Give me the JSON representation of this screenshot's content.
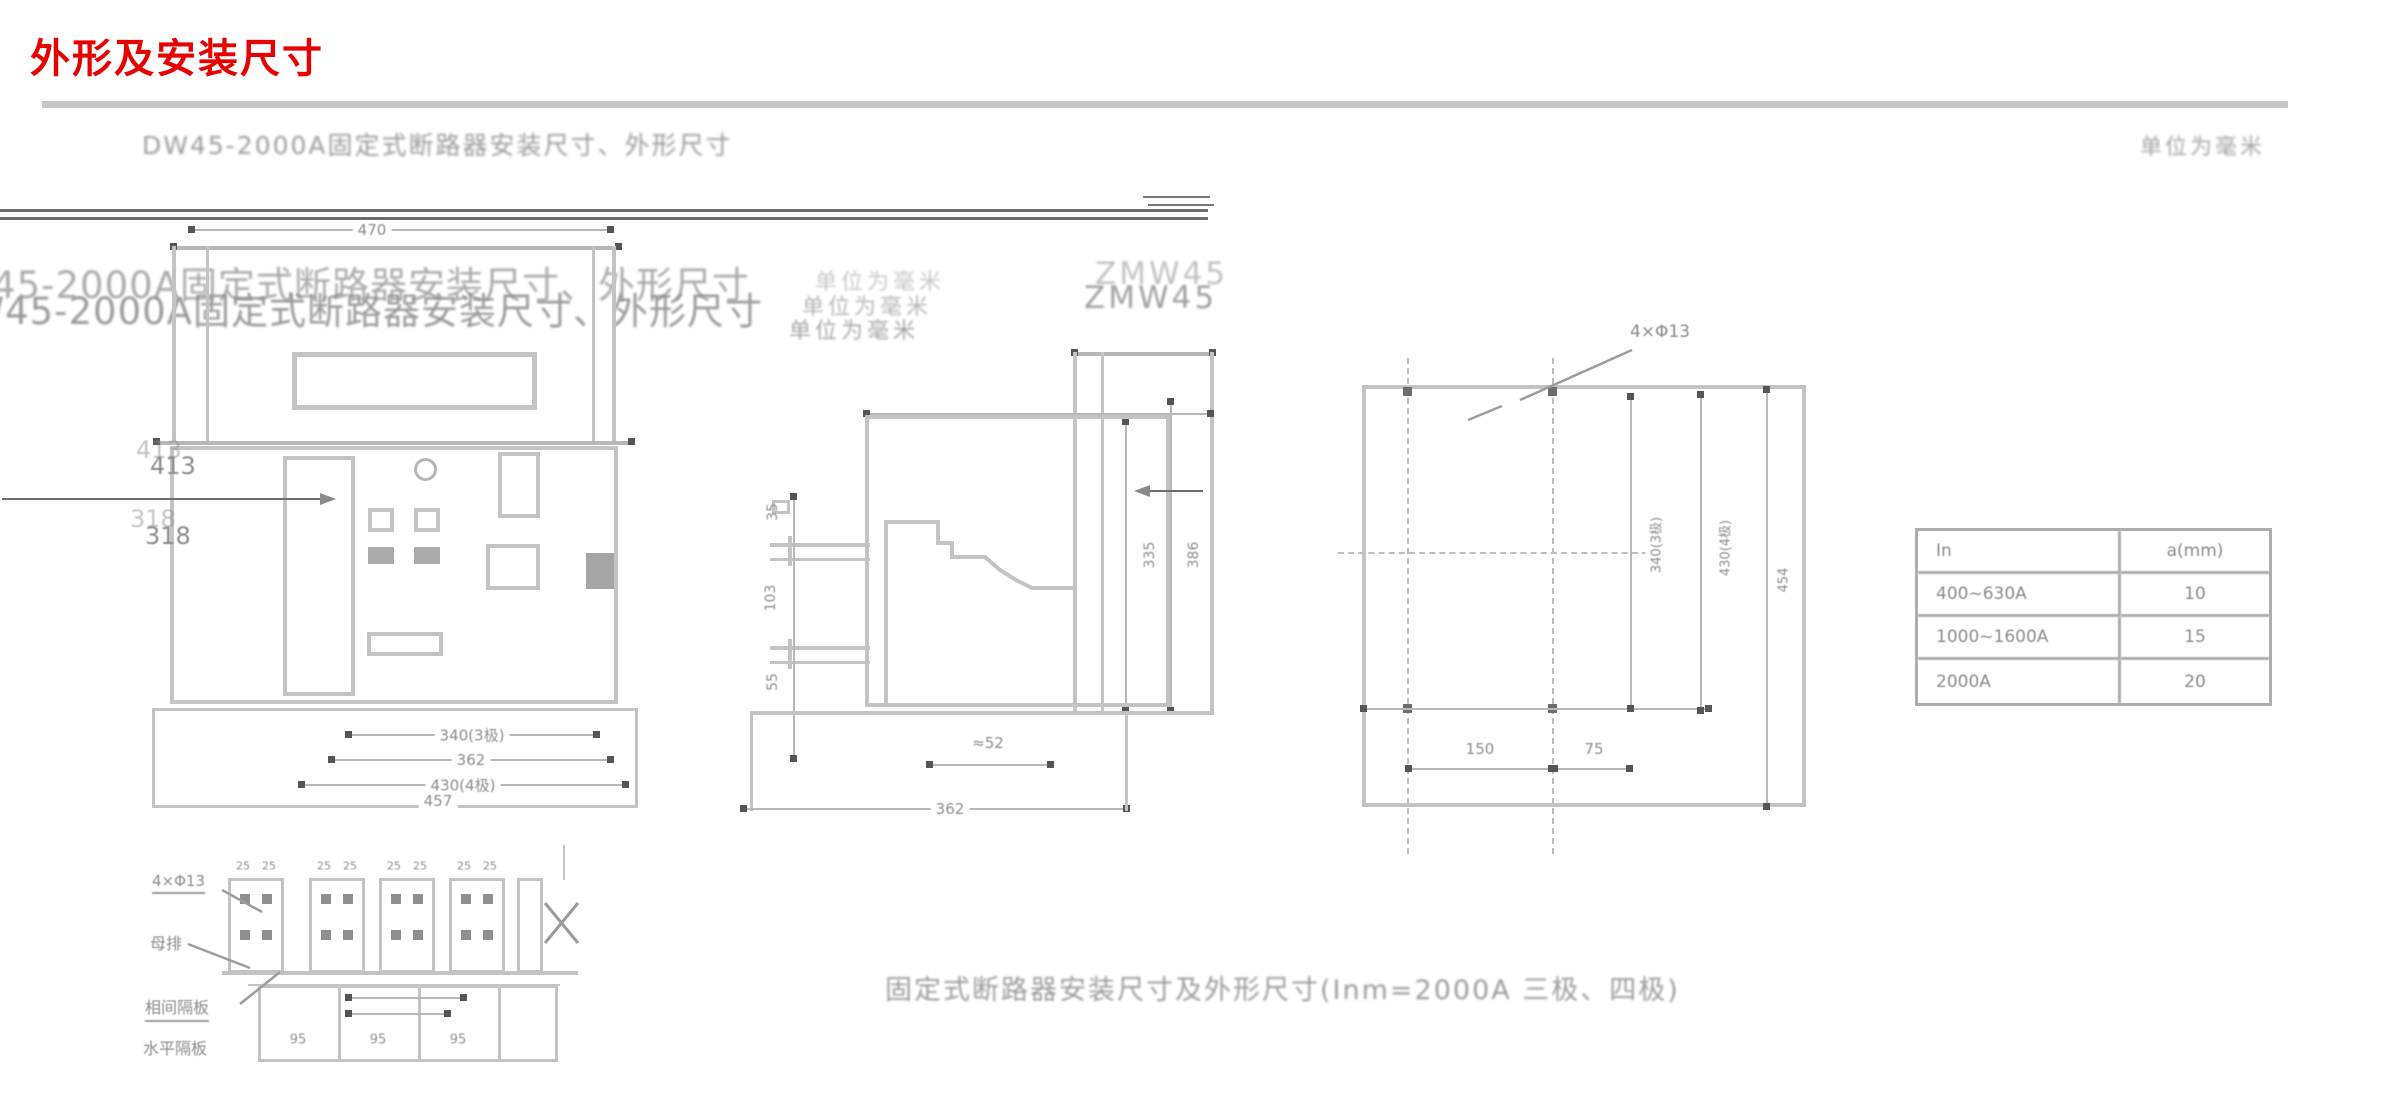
{
  "page": {
    "title": "外形及安装尺寸",
    "subtitle": "DW45-2000A固定式断路器安装尺寸、外形尺寸",
    "unit_note": "单位为毫米",
    "caption": "固定式断路器安装尺寸及外形尺寸(Inm=2000A 三极、四极)"
  },
  "ghost": {
    "heading": "DW45-2000A固定式断路器安装尺寸、外形尺寸",
    "unit": "单位为毫米",
    "model": "ZMW45"
  },
  "front_view": {
    "dim_top": "470",
    "dim_height_upper": "413",
    "dim_height_lower": "318",
    "dims_bottom": [
      "340(3极)",
      "362",
      "430(4极)",
      "457"
    ]
  },
  "side_view": {
    "dims_left": [
      "35",
      "103",
      "55"
    ],
    "dims_right": [
      "335",
      "386"
    ],
    "dim_bottom_inner": "≈52",
    "dim_bottom_overall": "362"
  },
  "plan_view": {
    "hole_label": "4×Φ13",
    "dims_right": [
      "340(3极)",
      "430(4极)",
      "454"
    ],
    "dim_bottom_inner": "150",
    "dim_bottom_offset": "75"
  },
  "terminal_detail": {
    "hole_label": "4×Φ13",
    "busbar_label": "母排",
    "barrier_label": "相间隔板",
    "base_label": "水平隔板",
    "hole_pitch": "25",
    "pole_pitch": "95"
  },
  "spec_table": {
    "headers": [
      "In",
      "a(mm)"
    ],
    "rows": [
      [
        "400~630A",
        "10"
      ],
      [
        "1000~1600A",
        "15"
      ],
      [
        "2000A",
        "20"
      ]
    ]
  },
  "colors": {
    "title_red": "#e60000",
    "line_gray": "#c3c3c3",
    "text_gray": "#8c8c8c"
  }
}
